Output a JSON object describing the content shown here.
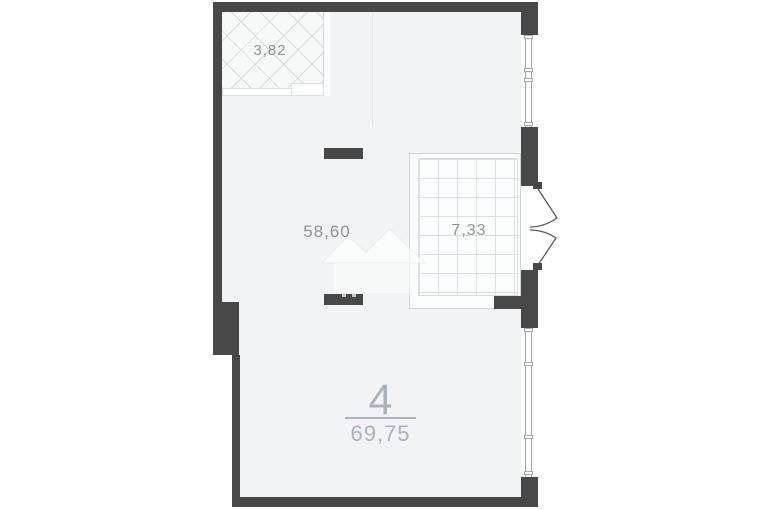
{
  "floorplan": {
    "balcony": {
      "area": "3,82",
      "pattern": "crosshatch"
    },
    "living_room": {
      "area": "58,60"
    },
    "loggia": {
      "area": "7,33",
      "pattern": "grid"
    },
    "unit": {
      "number": "4",
      "total_area": "69,75"
    }
  },
  "colors": {
    "wall": "#484848",
    "floor": "#f1f3f4",
    "area_label": "#909495",
    "unit_accent": "#a9b3bd"
  }
}
